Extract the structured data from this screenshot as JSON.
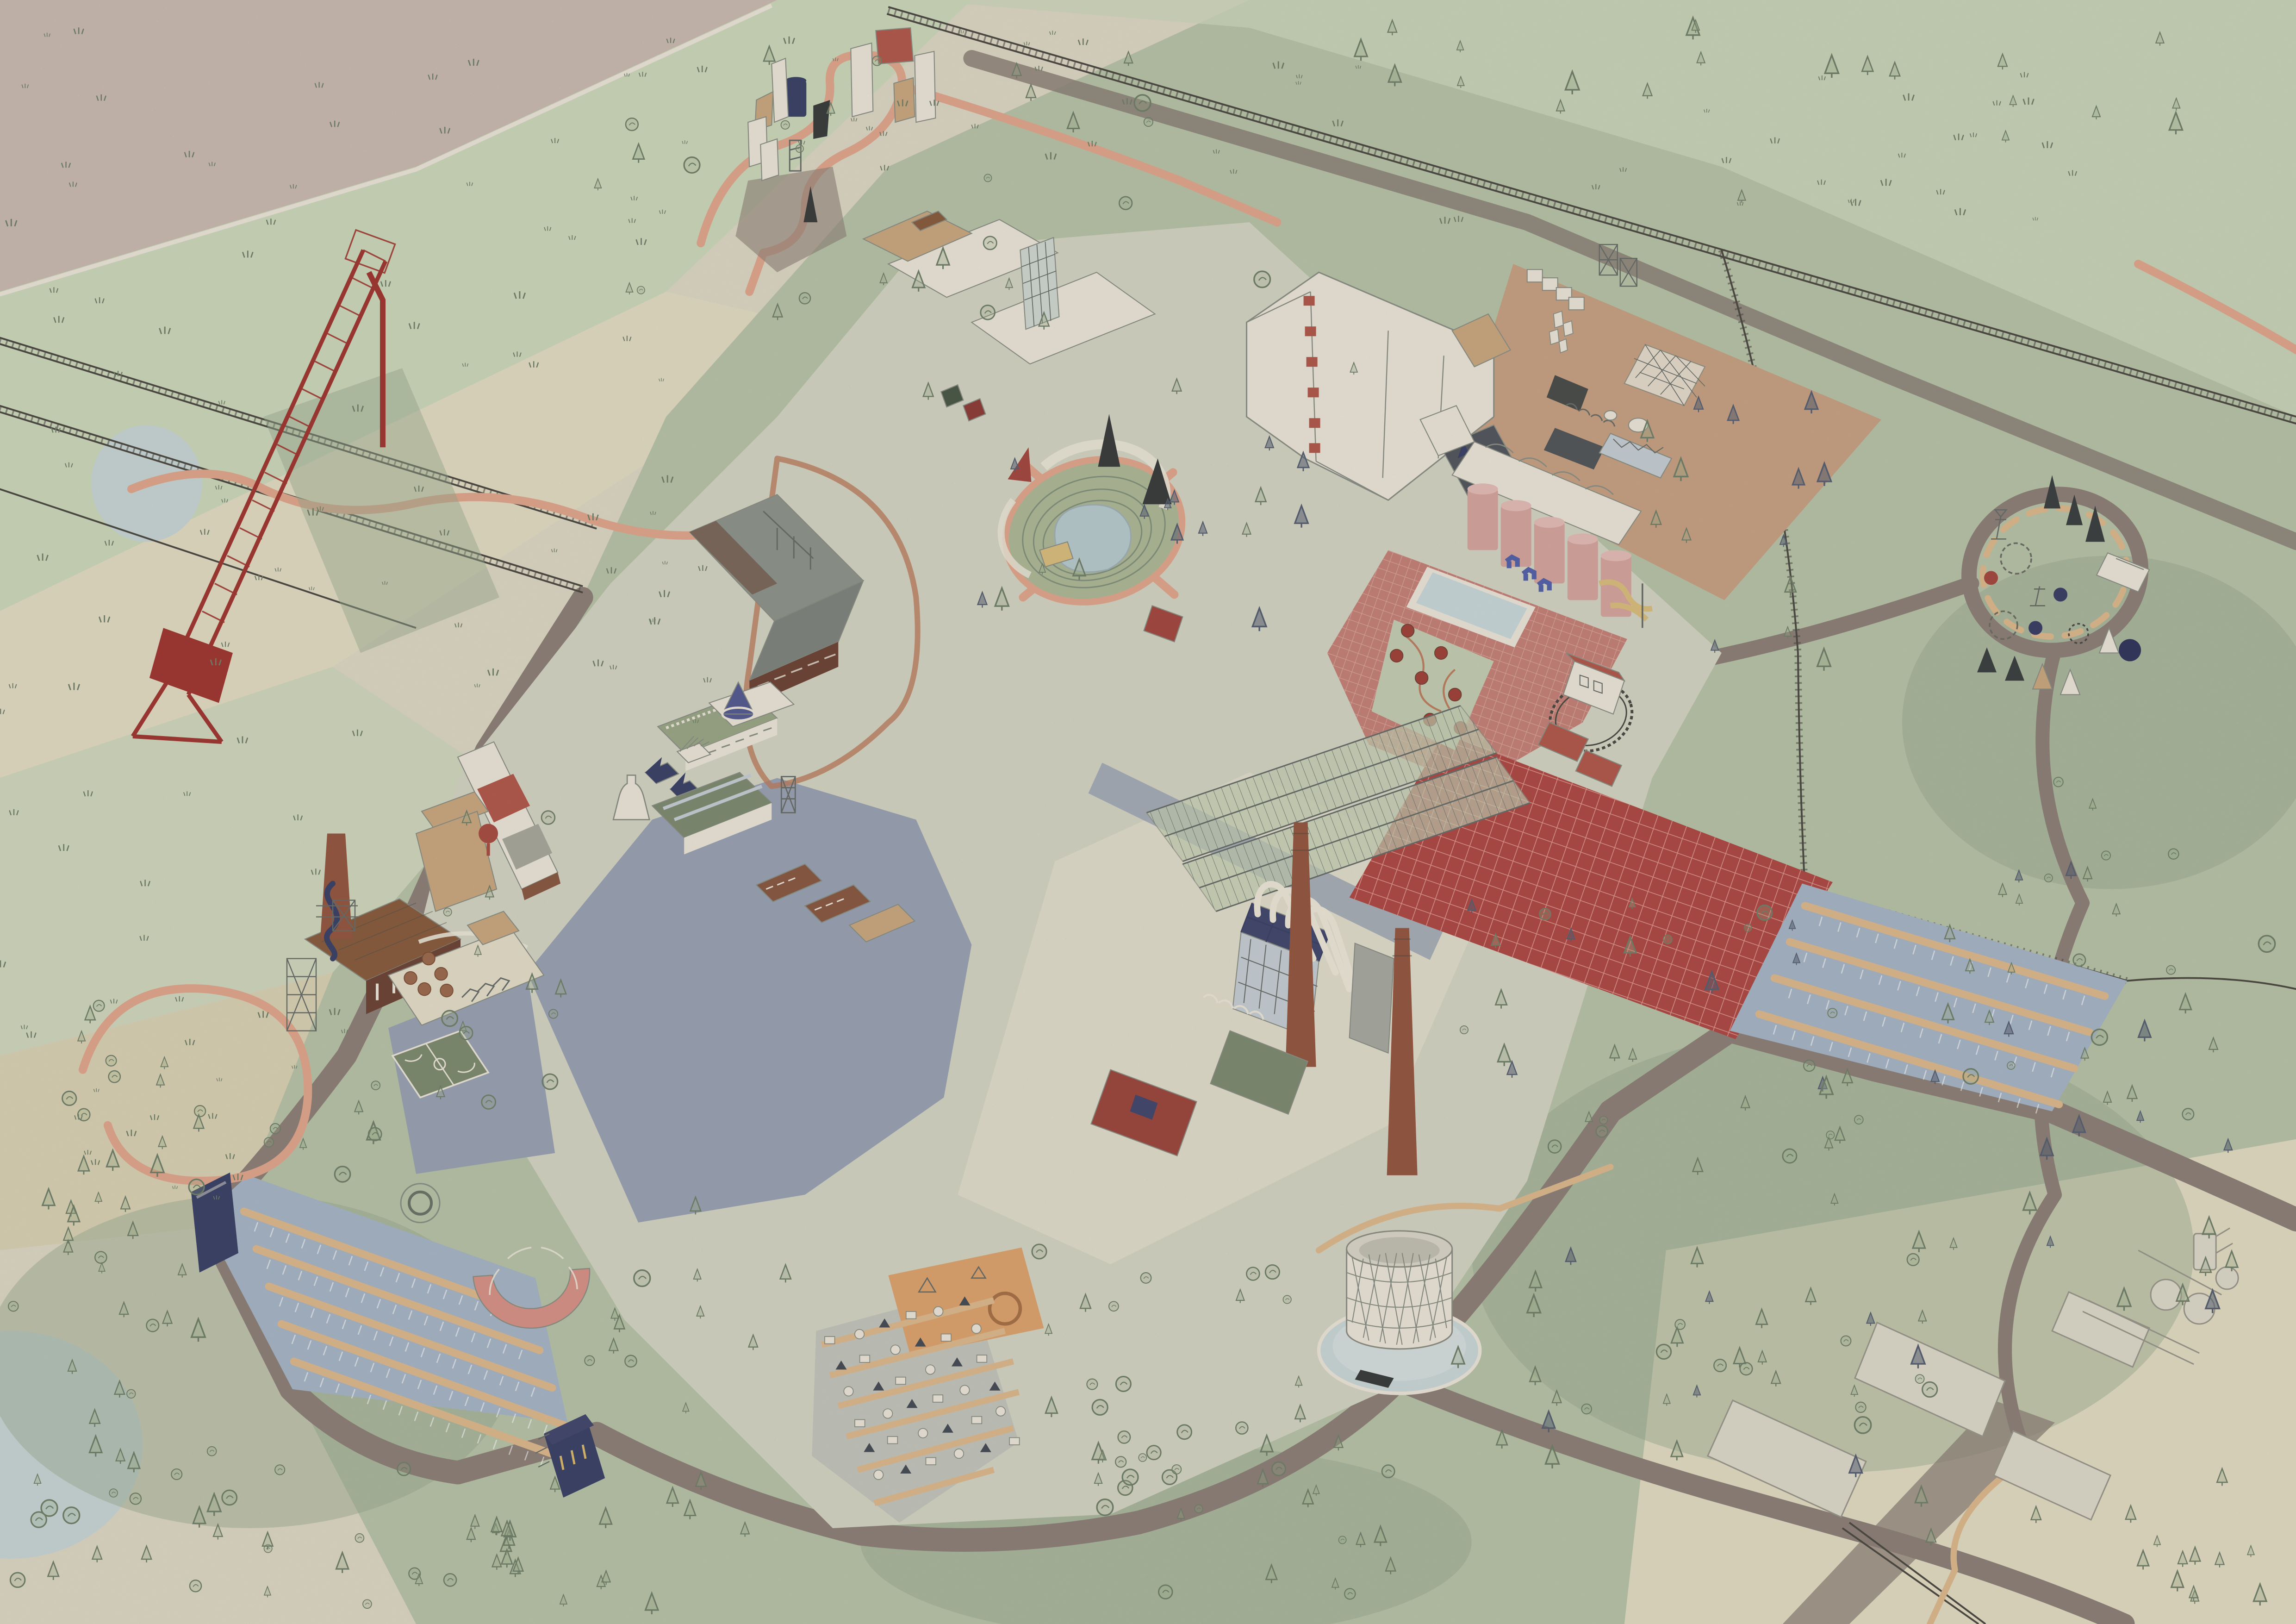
{
  "scene": {
    "type": "illustrated-axonometric-masterplan",
    "description": "Hand-drawn axonometric masterplan of a former industrial works converted into a public park campus, surrounded by striped farmland, pine forest, winding trails and railway lines",
    "style": "watercolour on textured paper, no text labels",
    "view": "isometric birds-eye"
  },
  "palette": {
    "paper": "#dcd6c3",
    "ink": "#4d524b",
    "inkSoft": "#8b8f85",
    "fieldMauve": "#c8bab0",
    "fieldGreenPale": "#ccd6ba",
    "fieldBeige": "#d8d0b2",
    "fieldBeige2": "#e1dac2",
    "meadow": "#b6c2a7",
    "meadowLight": "#c3cdb1",
    "forestShade": "#9aab90",
    "water": "#c6d4d3",
    "pondBlue": "#b8cacd",
    "road": "#8d8178",
    "roadDark": "#7b7168",
    "rail": "#4f4c45",
    "pathOrange": "#dfa78c",
    "pathOrangeEdge": "#bc7f62",
    "pathTan": "#dcb88d",
    "paving": "#d3d3c3",
    "pavingCream": "#e0dccb",
    "pavingBlue": "#9aa2b2",
    "gravel": "#c2c4bc",
    "plazaTan": "#c6a083",
    "plazaRed": "#c48279",
    "brickLine": "#d8a79b",
    "fieldRed": "#ae4b46",
    "gridRed": "#d9948c",
    "parkingBlue": "#a7b4c4",
    "craneRed": "#a03a33",
    "brick": "#8a5a45",
    "brickDark": "#6f4638",
    "brickChimney": "#955843",
    "roofWhite": "#e9e4d6",
    "roofGreen": "#9aa786",
    "roofGreenDark": "#7e8b71",
    "roofNavy": "#454a6e",
    "navy": "#3e4468",
    "roofRed": "#b25a4e",
    "roofBrown": "#8a5e41",
    "roofTan": "#c9a87f",
    "concrete": "#a8a9a0",
    "glass": "#c5cdd2",
    "steel": "#6a6f6a",
    "black": "#3c3f3e",
    "darkGray": "#55585f",
    "treeLine": "#72806b",
    "treeDark": "#596273",
    "treeFill": "#9db08d",
    "sand": "#e2dcc6",
    "courtGreen": "#7e8c70",
    "playOrange": "#dca36f",
    "siloPink": "#d4a49e",
    "siloPinkLight": "#e3bcb5",
    "poolBlue": "#c7d6d8",
    "horseBlue": "#5563a8",
    "slideTan": "#d9bd7e",
    "kilnRed": "#a0443c",
    "pipeWhite": "#eae5d6",
    "terrace": "#84927c",
    "chalk": "#efece0"
  },
  "features": {
    "crane": {
      "label": "red lattice gantry crane over railway"
    },
    "railway": {
      "label": "railway tracks with sleepers"
    },
    "fields": {
      "label": "diagonal striped farmland with grass tufts"
    },
    "cranePond": {
      "label": "pond beside crane"
    },
    "cornerPond": {
      "label": "lake in south-west corner"
    },
    "village": {
      "label": "sculpture village with monoliths and serpentine path"
    },
    "whiteHalls": {
      "label": "white exhibition halls with tan gable roofs"
    },
    "foldedHall": {
      "label": "white folded-plate hall with red roof vents",
      "vent_count": 6
    },
    "atrium": {
      "label": "glass grid atrium"
    },
    "amphitheatre": {
      "label": "sunken turf amphitheatre with pond stage"
    },
    "tanPlaza": {
      "label": "terracotta event plaza"
    },
    "spaceFrame": {
      "label": "white space-frame canopy"
    },
    "silos": {
      "label": "pink grain silos",
      "count": 5
    },
    "vaults": {
      "label": "vaulted white halls behind silos"
    },
    "pool": {
      "label": "reflecting pool on red plaza"
    },
    "horses": {
      "label": "blue horse sculptures",
      "count": 3
    },
    "slides": {
      "label": "timber slides off silos"
    },
    "redPlaza": {
      "label": "red brick-paved plaza"
    },
    "kilnGarden": {
      "label": "garden of round kiln columns",
      "kiln_count": 7
    },
    "trainLoop": {
      "label": "miniature railway loop"
    },
    "engineShed": {
      "label": "engine shed with red roof"
    },
    "greenhouses": {
      "label": "steel-frame greenhouses",
      "count": 2
    },
    "redField": {
      "label": "red tilled production field"
    },
    "eastParking": {
      "label": "east parking grove with tan aisles"
    },
    "powerPlant": {
      "label": "boiler house with white flue pipes",
      "chimney_count": 2
    },
    "chimneyA": {
      "label": "tall brick chimney"
    },
    "chimneyB": {
      "label": "second brick chimney"
    },
    "gasometer": {
      "label": "open lattice gasometer cylinder"
    },
    "campground": {
      "label": "campground with tents and yurts"
    },
    "playOrchard": {
      "label": "orange play orchard with rope ring"
    },
    "westParking": {
      "label": "drive-in parking field"
    },
    "screen": {
      "label": "drive-in cinema screen"
    },
    "arcade": {
      "label": "semicircular arcade with pink fan roof"
    },
    "eventHall": {
      "label": "navy event hall"
    },
    "playground": {
      "label": "playground with sand pits and trampolines"
    },
    "basketball": {
      "label": "basketball court"
    },
    "slideChimney": {
      "label": "brick chimney with navy spiral slide"
    },
    "brickWorks": {
      "label": "brick workshop with brown roof"
    },
    "longShed": {
      "label": "long shed with red and white roof bays"
    },
    "kilnBottle": {
      "label": "white bottle kiln"
    },
    "coneDome": {
      "label": "blue cone pavilion"
    },
    "greenHallA": {
      "label": "green-roofed hall with clerestory"
    },
    "greenHallB": {
      "label": "sage glass-ridge hall"
    },
    "navyTowers": {
      "label": "navy pyramid-roof towers"
    },
    "lBuilding": {
      "label": "L-shaped dark factory hall"
    },
    "rowHouses": {
      "label": "brick row houses"
    },
    "sculpturePark": {
      "label": "east sculpture park with obelisks and swing rings"
    },
    "pavilion": {
      "label": "white park pavilion"
    },
    "tentRow": {
      "label": "pyramid tent row"
    },
    "ghostWorks": {
      "label": "adjacent works drawn in outline"
    },
    "forest": {
      "label": "sketched pine and broadleaf forest"
    },
    "paths": {
      "label": "salmon walking trails"
    },
    "roads": {
      "label": "mauve site roads"
    },
    "esplanade": {
      "label": "cream central esplanade"
    },
    "blueRoad": {
      "label": "blue-grey service road"
    }
  }
}
